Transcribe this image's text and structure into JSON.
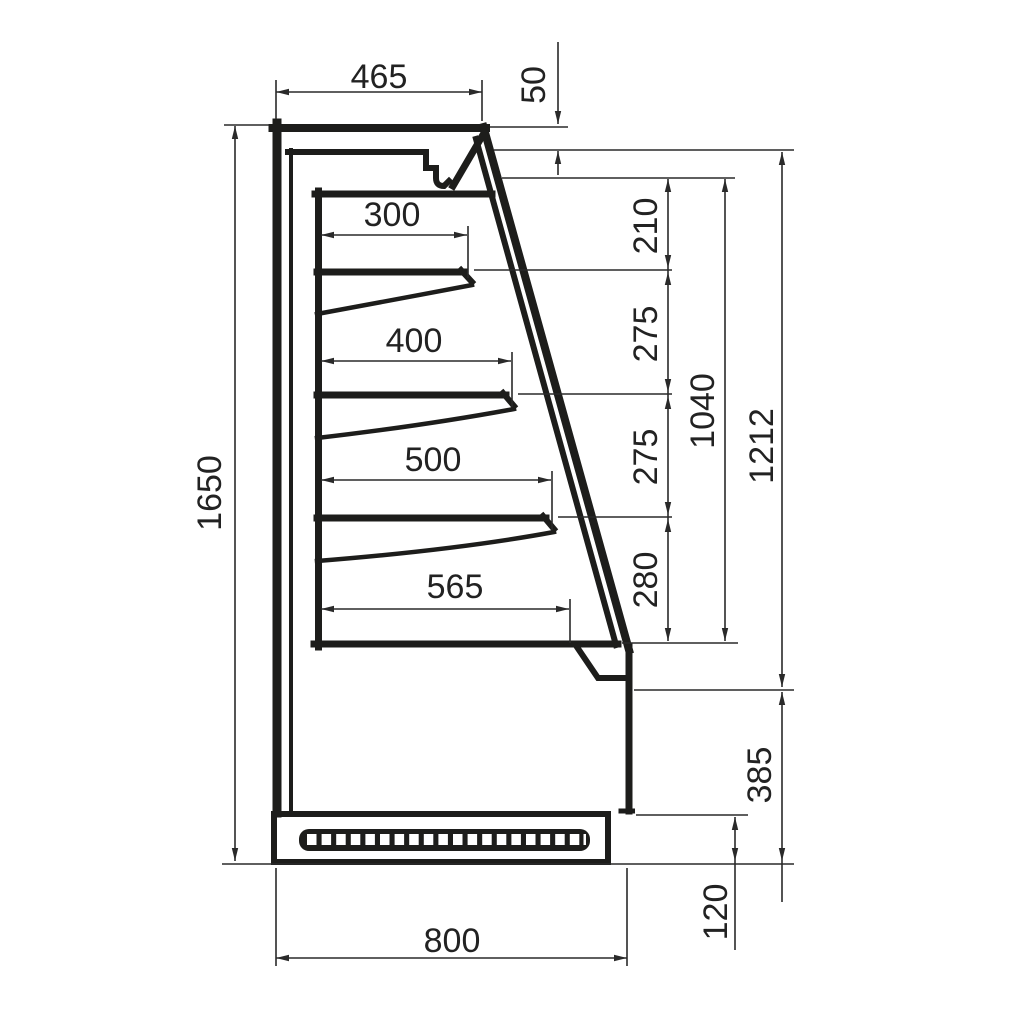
{
  "drawing": {
    "background_color": "#ffffff",
    "line_color": "#1d1d1b",
    "dim_color": "#2a2a2a",
    "dimensions_mm": {
      "canopy_depth": "465",
      "canopy_front_height": "50",
      "shelf_1_depth": "300",
      "shelf_2_depth": "400",
      "shelf_3_depth": "500",
      "bottom_shelf_depth": "565",
      "opening_top_gap": "210",
      "shelf_gap_1": "275",
      "shelf_gap_2": "275",
      "shelf_gap_3": "280",
      "opening_height": "1040",
      "upper_front_height": "1212",
      "lower_front_height": "385",
      "plinth_height": "120",
      "overall_height": "1650",
      "overall_depth": "800"
    }
  }
}
